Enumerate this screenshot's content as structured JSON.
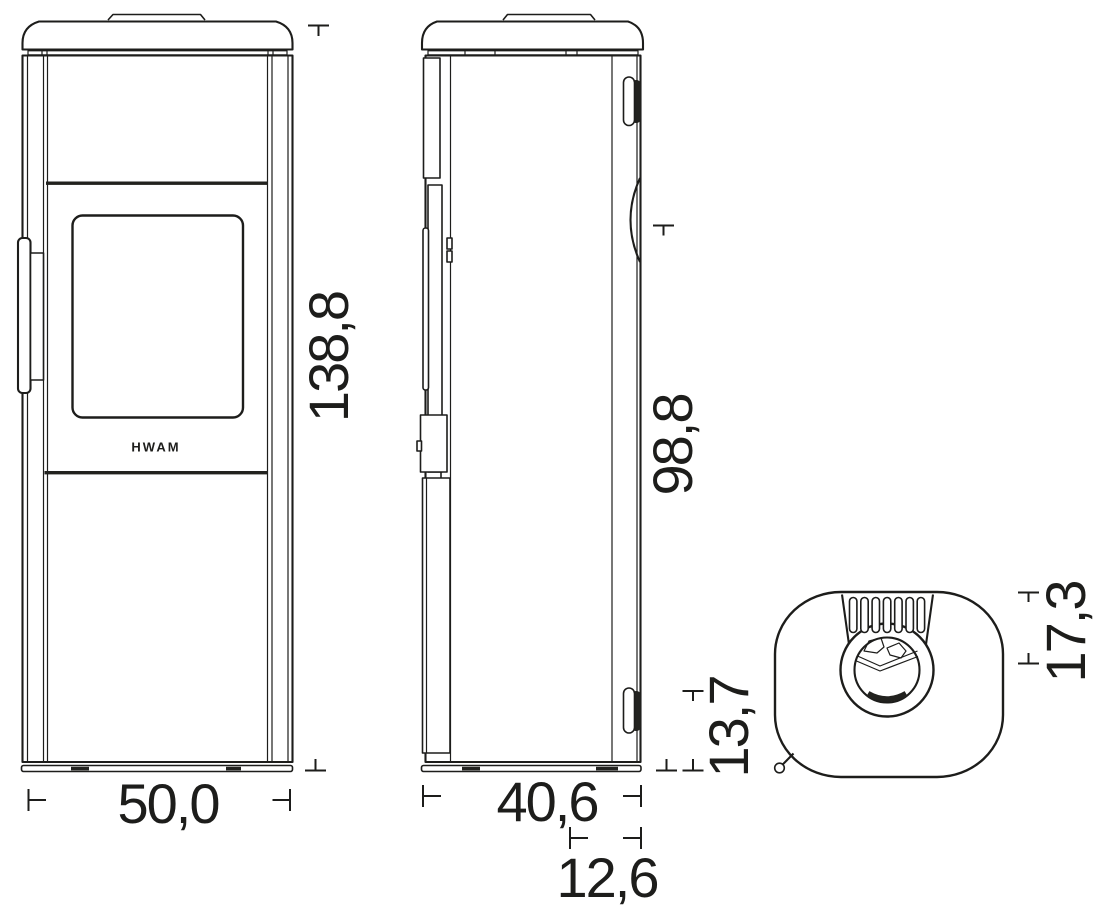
{
  "brand_logo": "HWAM",
  "dimensions": {
    "front_width": "50,0",
    "front_height": "138,8",
    "side_depth": "40,6",
    "side_rear_depth": "12,6",
    "rear_outlet_height": "98,8",
    "rear_lower_height": "13,7",
    "top_outlet_offset": "17,3"
  },
  "colors": {
    "line": "#1d1d1b",
    "background": "#ffffff"
  }
}
